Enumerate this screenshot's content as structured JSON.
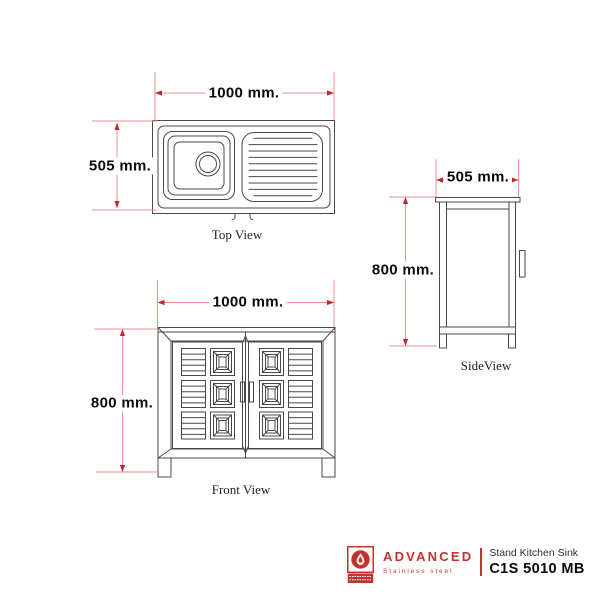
{
  "views": {
    "top": {
      "label": "Top View",
      "width_dim": "1000 mm.",
      "height_dim": "505 mm."
    },
    "front": {
      "label": "Front View",
      "width_dim": "1000 mm.",
      "height_dim": "800 mm."
    },
    "side": {
      "label": "SideView",
      "width_dim": "505 mm.",
      "height_dim": "800 mm."
    }
  },
  "footer": {
    "brand": "ADVANCED",
    "brand_sub": "Stainless steel",
    "product_type": "Stand Kitchen Sink",
    "model": "C1S 5010 MB"
  },
  "colors": {
    "drawing_line": "#494949",
    "dimension_line": "#ec8f8f",
    "arrow": "#c1272d",
    "brand_red": "#c5322e",
    "text": "#0a0a0a"
  }
}
